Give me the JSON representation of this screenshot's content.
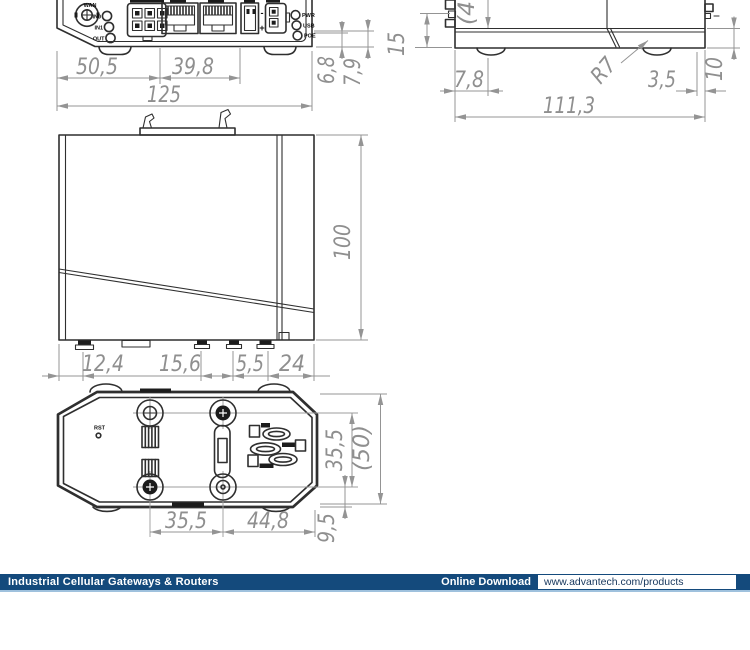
{
  "page": {
    "background": "#ffffff"
  },
  "footer": {
    "bar_color": "#144a7c",
    "left_label": "Industrial Cellular Gateways & Routers",
    "download_label": "Online Download",
    "url": "www.advantech.com/products"
  },
  "panel": {
    "ant_label": "WAN",
    "io_labels": [
      "IN0",
      "IN1",
      "OUT"
    ],
    "led_labels": [
      "PWR",
      "USB",
      "POE"
    ],
    "minus": "-",
    "plus": "+"
  },
  "bottom_view": {
    "reset_label": "RST"
  },
  "dims": {
    "front_seg1": "50,5",
    "front_seg2": "39,8",
    "front_total": "125",
    "front_off1": "6,8",
    "front_off2": "7,9",
    "side_height": "15",
    "side_ref_top": "(4",
    "side_foot_offset": "7,8",
    "side_right_offset": "3,5",
    "side_total": "111,3",
    "side_plate": "10",
    "side_radius": "R7",
    "face_height": "100",
    "bottom_seg1": "12,4",
    "bottom_seg2": "15,6",
    "bottom_seg3": "5,5",
    "bottom_seg4": "24",
    "bot_screw_v": "35,5",
    "bot_depth": "(50)",
    "bot_screw_h": "35,5",
    "bot_right": "44,8",
    "bot_edge": "9,5"
  }
}
